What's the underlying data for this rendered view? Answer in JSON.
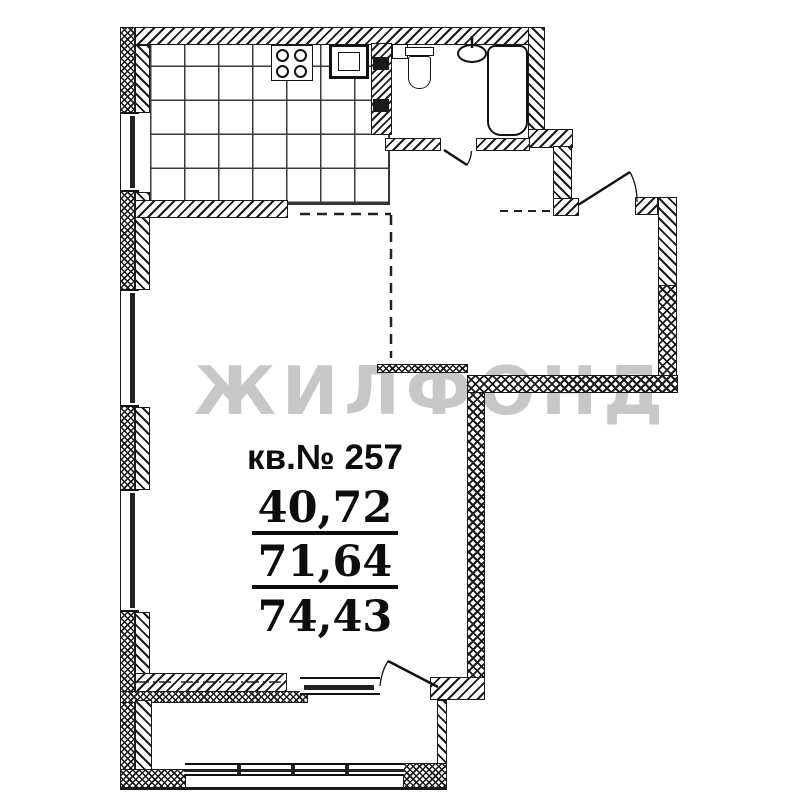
{
  "plan": {
    "watermark": "ЖИЛФОНД",
    "apartment_label": "кв.№ 257",
    "areas": {
      "living": "40,72",
      "total": "71,64",
      "with_balcony": "74,43"
    },
    "colors": {
      "line": "#1a1a1a",
      "watermark": "#c7c7c7",
      "background": "#ffffff"
    },
    "rooms": [
      "kitchen",
      "living-room",
      "hallway",
      "bathroom",
      "balcony"
    ],
    "fixtures": [
      "stove-icon",
      "kitchen-sink-icon",
      "ventilation-shaft",
      "toilet-icon",
      "washbasin-icon",
      "bathtub-icon",
      "balcony-glazing",
      "entrance-door",
      "bathroom-door",
      "balcony-door"
    ]
  }
}
